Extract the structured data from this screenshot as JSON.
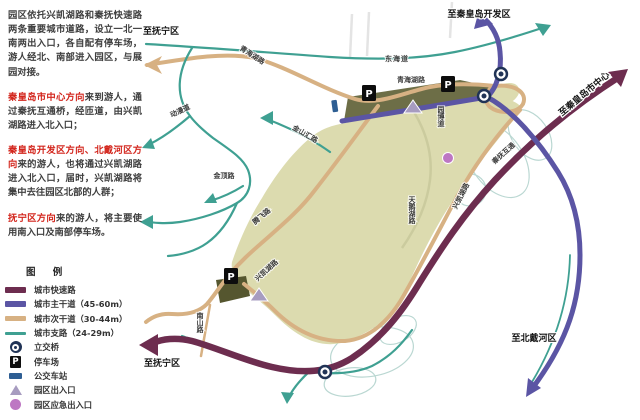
{
  "colors": {
    "expressway": "#6d2d4f",
    "arterial": "#5b55a4",
    "secondary": "#d7b183",
    "branch": "#3fa092",
    "park_fill": "#dcdbaf",
    "north_strip": "#6d6e47",
    "building": "#55562f",
    "entrance_triangle": "#a79cc0",
    "emergency_circle": "#bd77c3",
    "interchange": "#203356",
    "bus_station": "#2e5e93",
    "highlight_text": "#d3261d"
  },
  "description": {
    "para1": "园区依托兴凯湖路和秦抚快速路两条重要城市道路，设立一北一南两出入口，各自配有停车场，游人经北、南部进入园区，与展园对接。",
    "para2_highlight": "秦皇岛市中心方向",
    "para2_text": "来到游人，通过秦抚互通桥，经匝道，由兴凯湖路进入北入口；",
    "para3_highlight": "秦皇岛开发区方向、北戴河区方向",
    "para3_text": "来的游人，也将通过兴凯湖路进入北入口，届时，兴凯湖路将集中去往园区北部的人群；",
    "para4_highlight": "抚宁区方向",
    "para4_text": "来的游人，将主要使用南入口及南部停车场。"
  },
  "legend": {
    "title": "图 例",
    "items": [
      {
        "label": "城市快速路"
      },
      {
        "label": "城市主干道（45-60m）"
      },
      {
        "label": "城市次干道（30-44m）"
      },
      {
        "label": "城市支路（24-29m）"
      },
      {
        "label": "立交桥"
      },
      {
        "label": "停车场"
      },
      {
        "label": "公交车站"
      },
      {
        "label": "园区出入口"
      },
      {
        "label": "园区应急出入口"
      }
    ]
  },
  "map": {
    "directions": [
      {
        "text": "至抚宁区"
      },
      {
        "text": "至秦皇岛开发区"
      },
      {
        "text": "至秦皇岛市中心"
      },
      {
        "text": "至北戴河区"
      },
      {
        "text": "至抚宁区"
      }
    ],
    "roads": [
      {
        "name": "东海道"
      },
      {
        "name": "青海湖路"
      },
      {
        "name": "青海湖路"
      },
      {
        "name": "动漫道"
      },
      {
        "name": "金山汇路"
      },
      {
        "name": "金顶路"
      },
      {
        "name": "腾飞路"
      },
      {
        "name": "园博道"
      },
      {
        "name": "秦抚互通"
      },
      {
        "name": "兴凯湖路"
      },
      {
        "name": "天鹅湖路"
      },
      {
        "name": "兴凯湖路"
      },
      {
        "name": "南山路"
      }
    ],
    "parking_label": "P"
  }
}
